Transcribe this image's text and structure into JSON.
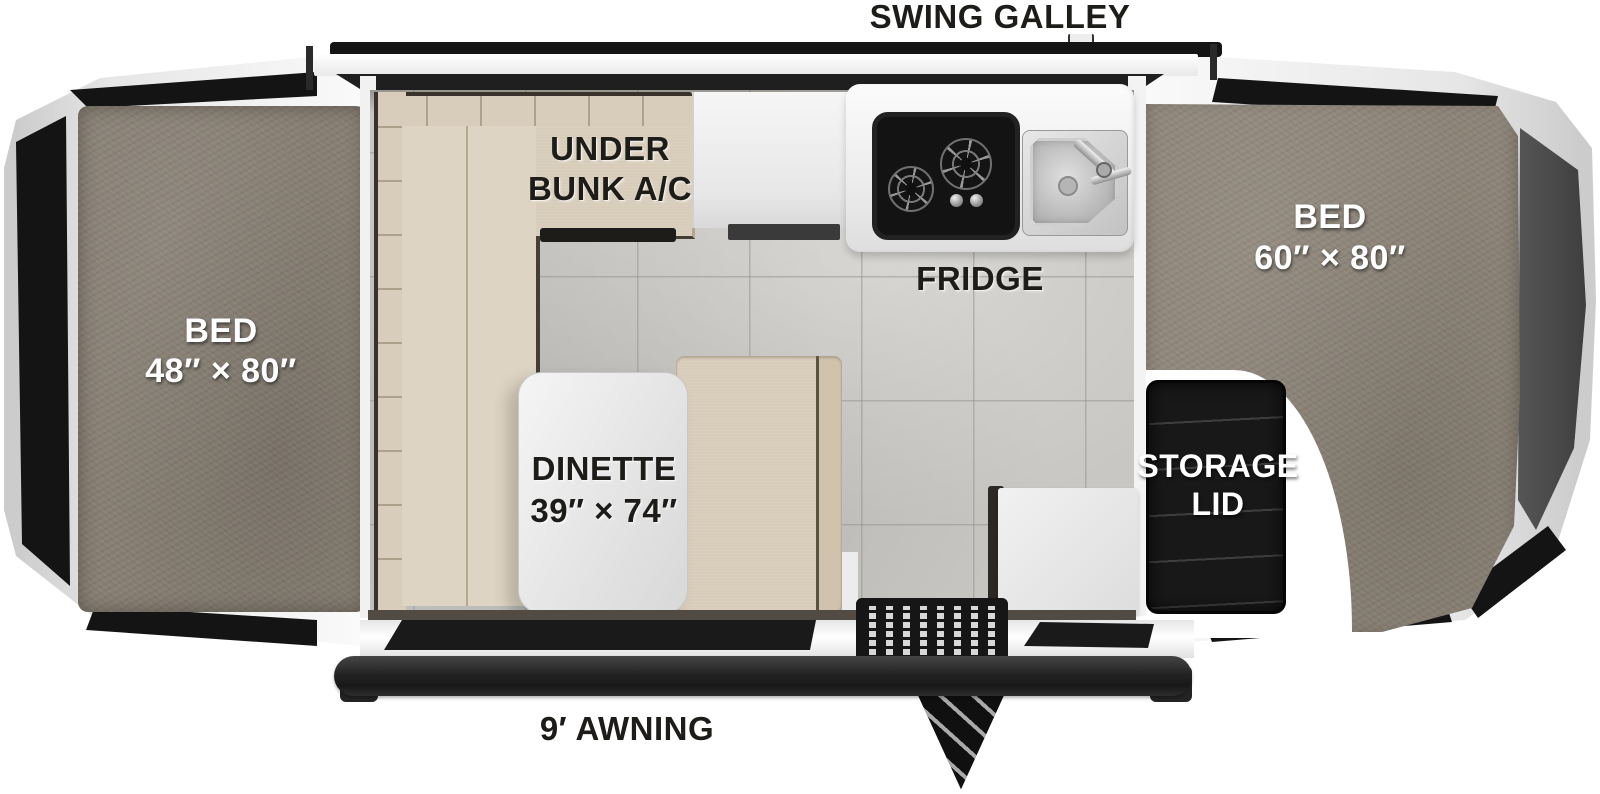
{
  "title": "SWING GALLEY",
  "floorplan": {
    "galley_label": "SWING GALLEY",
    "awning_label": "9′ AWNING",
    "fridge_label": "FRIDGE",
    "bed_left": {
      "name": "BED",
      "size": "48″ × 80″"
    },
    "bed_right": {
      "name": "BED",
      "size": "60″ × 80″"
    },
    "under_bunk_ac": {
      "line1": "UNDER",
      "line2": "BUNK A/C"
    },
    "dinette": {
      "name": "DINETTE",
      "size": "39″ × 74″"
    },
    "storage_lid": {
      "line1": "STORAGE",
      "line2": "LID"
    }
  },
  "colors": {
    "carpet": "#8d8478",
    "cushion": "#d8cdbb",
    "floor_tile": "#c9c7c3",
    "counter_white": "#f2f2f2",
    "appliance_black": "#161616",
    "label_black": "#1d1c19",
    "label_white": "#ffffff"
  }
}
